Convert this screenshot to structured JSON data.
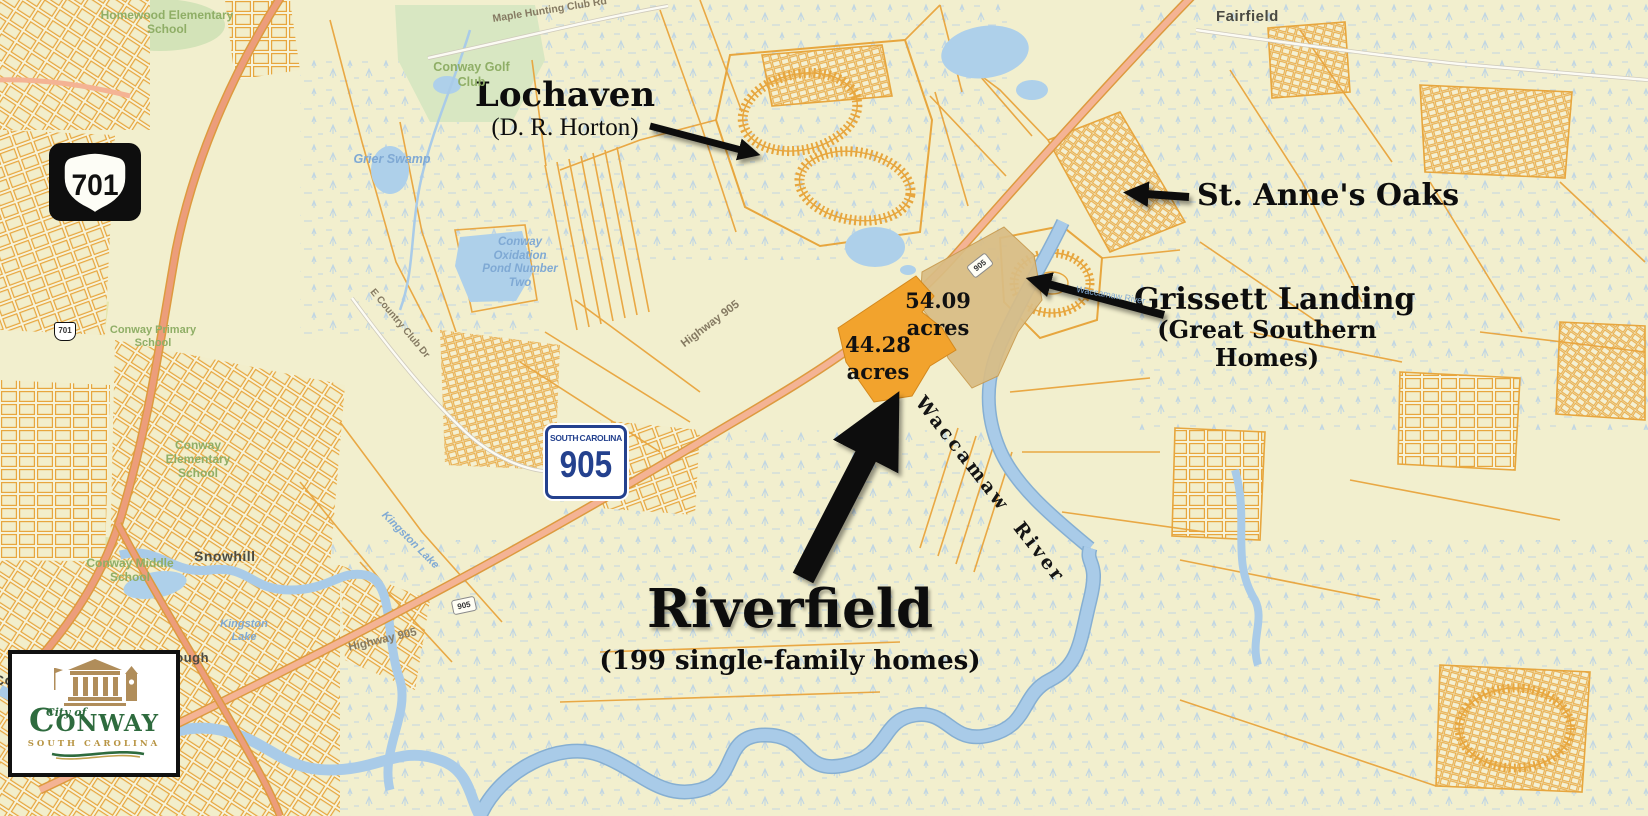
{
  "annotations": {
    "lochaven": {
      "name": "Lochaven",
      "developer": "(D. R. Horton)"
    },
    "st_annes_oaks": {
      "name": "St. Anne's Oaks"
    },
    "grissett_landing": {
      "name": "Grissett Landing",
      "developer": "(Great Southern Homes)"
    },
    "riverfield": {
      "name": "Riverfield",
      "detail": "(199 single-family homes)"
    }
  },
  "parcels": {
    "tract_54": {
      "acres": "54.09",
      "unit": "acres"
    },
    "tract_44": {
      "acres": "44.28",
      "unit": "acres"
    }
  },
  "shields": {
    "us701": "701",
    "sc905": {
      "top_left": "SOUTH",
      "top_right": "CAROLINA",
      "number": "905"
    },
    "mini_701": "701",
    "mini_905_a": "905",
    "mini_905_b": "905"
  },
  "place_labels": {
    "fairfield": "Fairfield",
    "snowhill": "Snowhill",
    "conwayborough": "Conwayborough",
    "conway_partial": "Conway",
    "homewood_school": "Homewood Elementary School",
    "golf_club": "Conway Golf Club",
    "primary_school": "Conway Primary School",
    "elementary_school": "Conway Elementary School",
    "middle_school": "Conway Middle School"
  },
  "water_labels": {
    "grier_swamp": "Grier Swamp",
    "oxidation_pond": "Conway Oxidation Pond Number Two",
    "kingston_lake": "Kingston Lake",
    "kingston_lake_upper": "Kingston Lake",
    "waccamaw_river": "Waccamaw  River",
    "waccamaw_river_small": "Waccamaw River"
  },
  "road_labels": {
    "maple_hunting": "Maple Hunting Club Rd",
    "hwy905_upper": "Highway 905",
    "hwy905_lower": "Highway 905",
    "country_club_dr": "E Country Club Dr"
  },
  "logo": {
    "city_of": "City of",
    "name": "CONWAY",
    "state": "SOUTH CAROLINA"
  },
  "colors": {
    "parcel_line": "#e8a33c",
    "parcel_orange": "#f2a32d",
    "parcel_tan": "#d9bd85",
    "highway_fill": "#f4b394",
    "water": "#a9cbe8",
    "annotation_text": "#0d0d0d",
    "label_green": "#8fae66",
    "label_blue": "#7fa9d4",
    "shield_blue": "#24418e",
    "logo_green": "#2e6b3e",
    "logo_gold": "#b89544"
  }
}
